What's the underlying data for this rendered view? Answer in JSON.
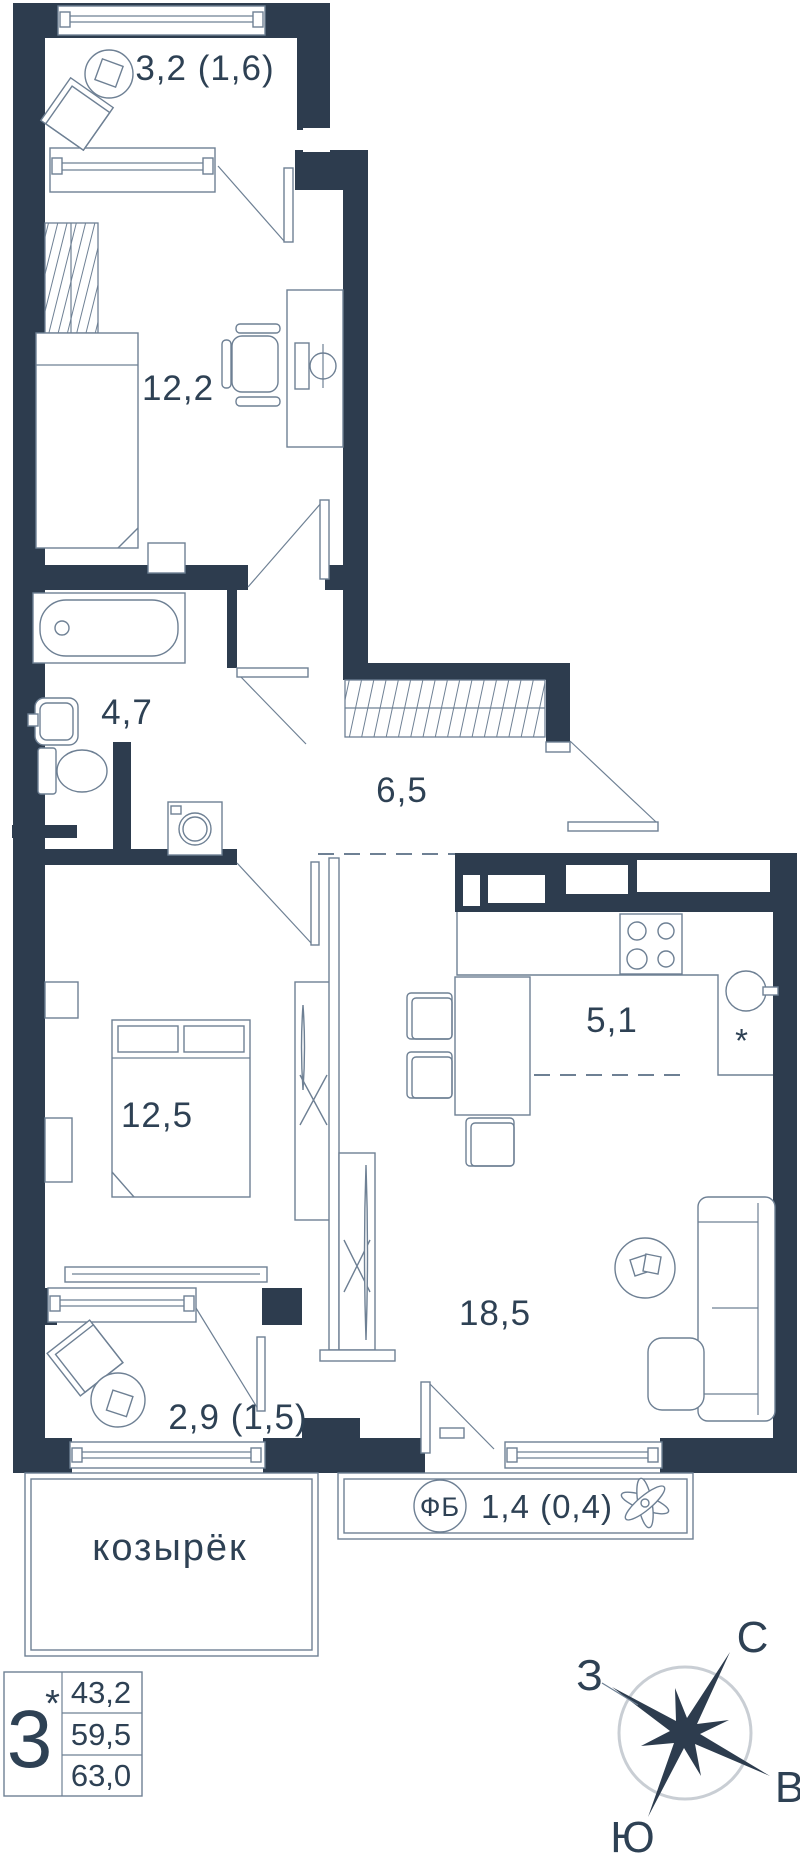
{
  "rooms": {
    "loggia_top": "3,2 (1,6)",
    "office": "12,2",
    "bathroom": "4,7",
    "hall": "6,5",
    "kitchen": "5,1",
    "bedroom": "12,5",
    "living": "18,5",
    "loggia_bottom": "2,9 (1,5)",
    "french_balcony": "1,4 (0,4)"
  },
  "annotations": {
    "canopy": "козырёк",
    "fb_badge": "ФБ",
    "fridge_mark": "*"
  },
  "legend": {
    "rooms_count": "3",
    "note_mark": "*",
    "area_living": "43,2",
    "area_apartment": "59,5",
    "area_total": "63,0"
  },
  "compass": {
    "north": "С",
    "south": "Ю",
    "west": "З",
    "east": "В"
  },
  "colors": {
    "wall": "#2d3c4e",
    "furniture_line": "#6e8094",
    "text": "#2e4154",
    "compass_ring": "#c9ced4"
  }
}
